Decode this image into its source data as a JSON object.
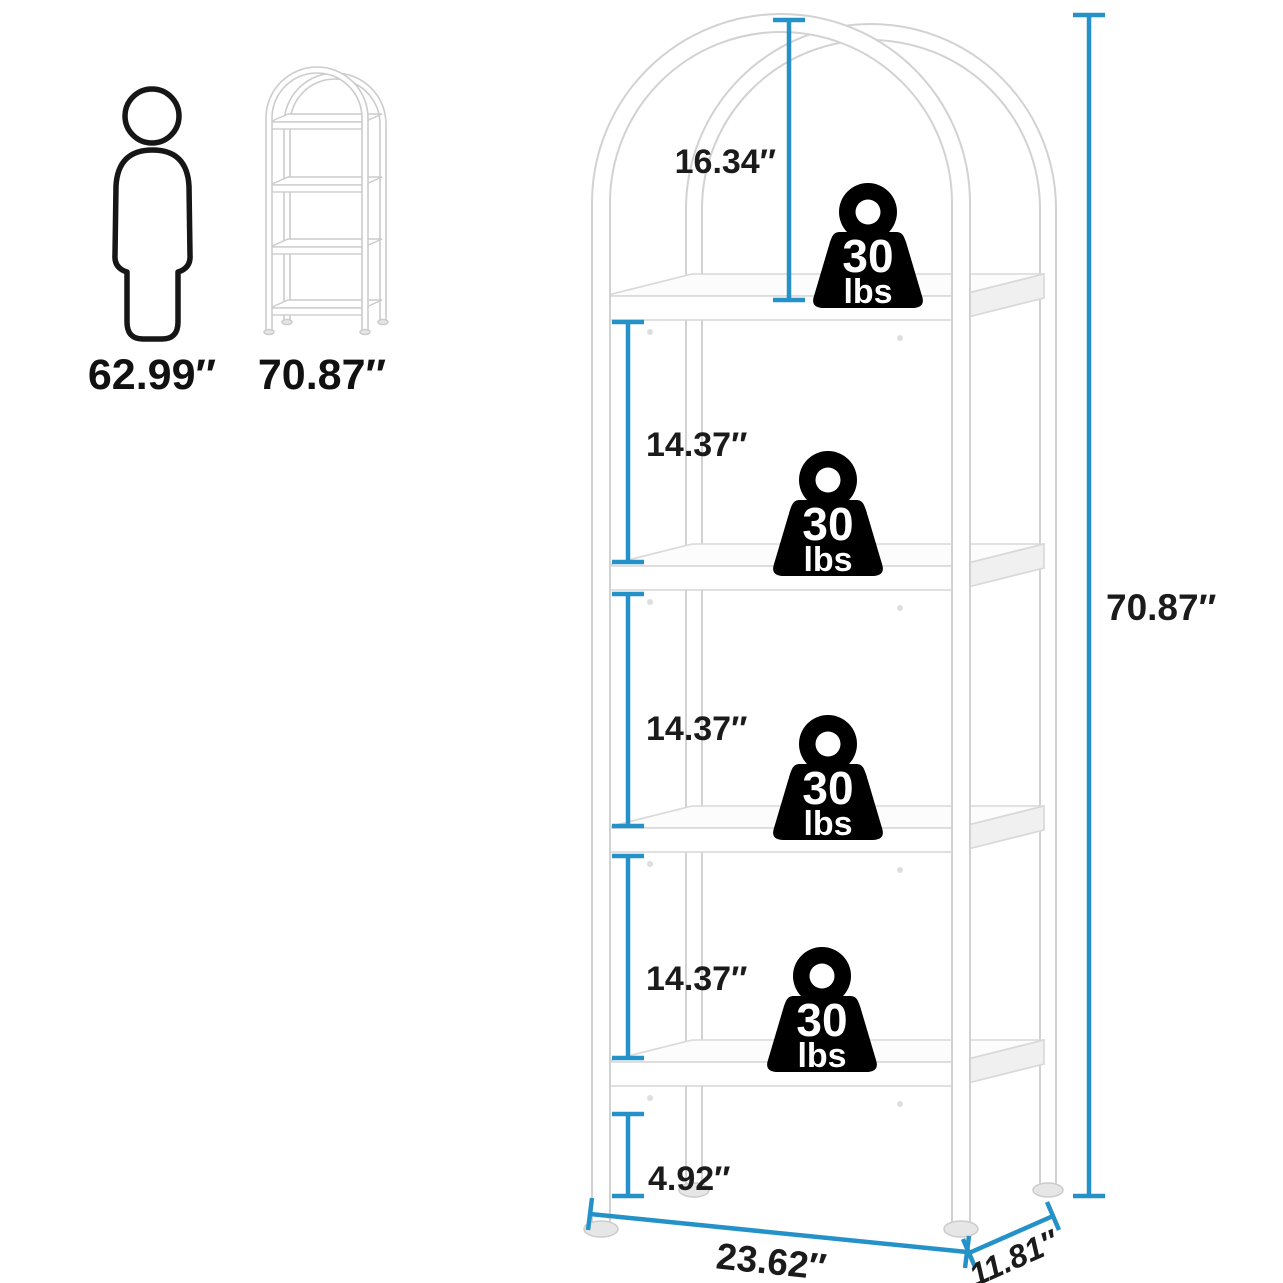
{
  "colors": {
    "dimension_line": "#2492c8",
    "label_text": "#1b1b1b",
    "weight_icon_fill": "#000000",
    "product_outline": "#d2d2d2",
    "background": "#ffffff"
  },
  "size_reference": {
    "person_height": "62.99″",
    "shelf_height": "70.87″"
  },
  "dimensions": {
    "total_height": "70.87″",
    "arch_to_top_shelf": "16.34″",
    "shelf_gap_1": "14.37″",
    "shelf_gap_2": "14.37″",
    "shelf_gap_3": "14.37″",
    "bottom_clearance": "4.92″",
    "width": "23.62″",
    "depth": "11.81″"
  },
  "weights": [
    {
      "value": "30",
      "unit": "lbs"
    },
    {
      "value": "30",
      "unit": "lbs"
    },
    {
      "value": "30",
      "unit": "lbs"
    },
    {
      "value": "30",
      "unit": "lbs"
    }
  ],
  "icons": {
    "person": "person-silhouette-icon",
    "reference_shelf": "arched-shelf-thumbnail-icon",
    "weight": "kettlebell-weight-icon"
  }
}
